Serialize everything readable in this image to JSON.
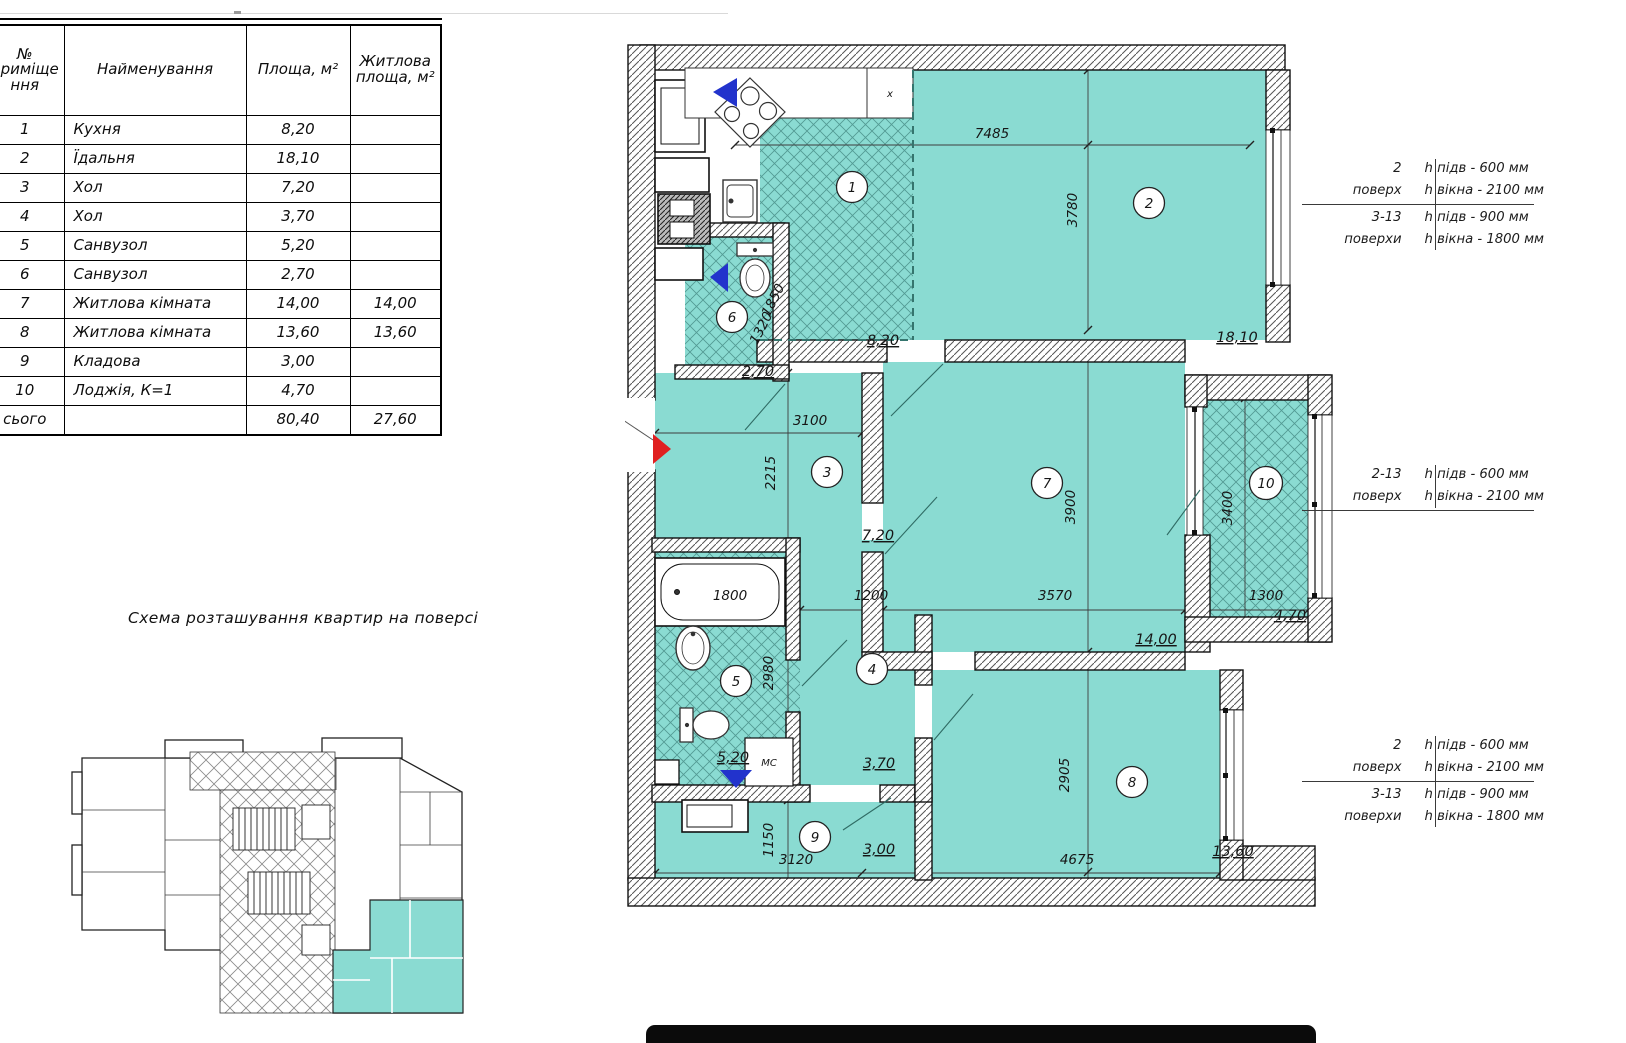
{
  "table": {
    "col_headers": [
      "№ приміщення",
      "Найменування",
      "Площа, м²",
      "Житлова площа, м²"
    ],
    "rows": [
      {
        "num": "1",
        "name": "Кухня",
        "area": "8,20",
        "living": ""
      },
      {
        "num": "2",
        "name": "Їдальня",
        "area": "18,10",
        "living": ""
      },
      {
        "num": "3",
        "name": "Хол",
        "area": "7,20",
        "living": ""
      },
      {
        "num": "4",
        "name": "Хол",
        "area": "3,70",
        "living": ""
      },
      {
        "num": "5",
        "name": "Санвузол",
        "area": "5,20",
        "living": ""
      },
      {
        "num": "6",
        "name": "Санвузол",
        "area": "2,70",
        "living": ""
      },
      {
        "num": "7",
        "name": "Житлова кімната",
        "area": "14,00",
        "living": "14,00"
      },
      {
        "num": "8",
        "name": "Житлова кімната",
        "area": "13,60",
        "living": "13,60"
      },
      {
        "num": "9",
        "name": "Кладова",
        "area": "3,00",
        "living": ""
      },
      {
        "num": "10",
        "name": "Лоджія, К=1",
        "area": "4,70",
        "living": ""
      }
    ],
    "total_label": "сього",
    "total_area": "80,40",
    "total_living": "27,60"
  },
  "scheme_title": "Схема розташування квартир на поверсі",
  "plan": {
    "room_numbers": {
      "r1": "1",
      "r2": "2",
      "r3": "3",
      "r4": "4",
      "r5": "5",
      "r6": "6",
      "r7": "7",
      "r8": "8",
      "r9": "9",
      "r10": "10"
    },
    "areas": {
      "r1": "8,20",
      "r2": "18,10",
      "r3": "7,20",
      "r4": "3,70",
      "r5": "5,20",
      "r6": "2,70",
      "r7": "14,00",
      "r8": "13,60",
      "r9": "3,00",
      "r10": "4,70"
    },
    "dims": {
      "top_width": "7485",
      "room2_height": "3780",
      "wc_width": "1320",
      "wc_height": "1850",
      "hall_width": "3100",
      "hall_height": "2215",
      "corridor": "1200",
      "room7_width": "3570",
      "room7_height": "3900",
      "loggia_height": "3400",
      "loggia_width": "1300",
      "tub": "1800",
      "bath_height": "2980",
      "storage_height": "1150",
      "storage_width": "3120",
      "room8_width": "4675",
      "room8_height": "2905"
    },
    "labels": {
      "washer": "МС",
      "vent": "x"
    }
  },
  "annotations": {
    "block1": {
      "row1_floor": "2",
      "row1_floor_word": "поверх",
      "row1_line1": "h підв - 600 мм",
      "row1_line2": "h вікна - 2100 мм",
      "row2_floor": "3-13",
      "row2_floor_word": "поверхи",
      "row2_line1": "h підв - 900 мм",
      "row2_line2": "h вікна - 1800 мм"
    },
    "block2": {
      "row1_floor": "2-13",
      "row1_floor_word": "поверх",
      "row1_line1": "h підв - 600 мм",
      "row1_line2": "h вікна - 2100 мм"
    },
    "block3": {
      "row1_floor": "2",
      "row1_floor_word": "поверх",
      "row1_line1": "h підв - 600 мм",
      "row1_line2": "h вікна - 2100 мм",
      "row2_floor": "3-13",
      "row2_floor_word": "поверхи",
      "row2_line1": "h підв - 900 мм",
      "row2_line2": "h вікна - 1800 мм"
    }
  },
  "colors": {
    "room_fill": "#8adbd2",
    "hatch_line": "#2e6e68",
    "wall_line": "#111111",
    "accent_blue": "#2233cc",
    "accent_red": "#e02020"
  }
}
